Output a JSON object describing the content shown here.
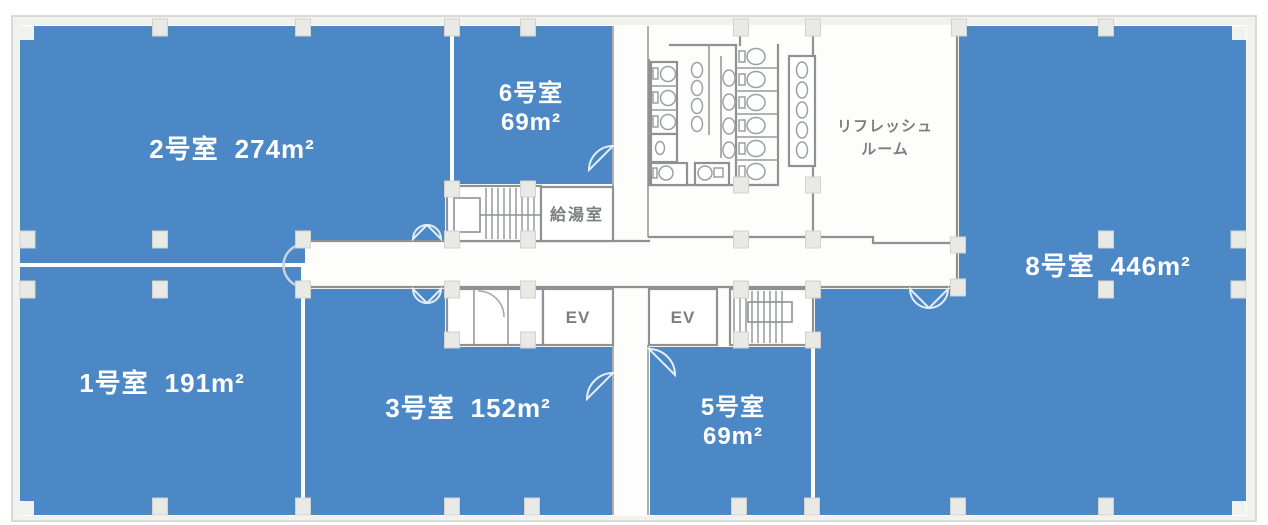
{
  "plan": {
    "type": "office-floor-plan",
    "colors": {
      "room_fill": "#4d88c6",
      "wall_line": "#8f9193",
      "wall_band": "#f1f1ee",
      "pillar": "#e9e9e5",
      "room_label": "#ffffff",
      "facility_label": "#7c7e80"
    },
    "rooms": [
      {
        "id": "1",
        "name": "1号室",
        "area": "191m²"
      },
      {
        "id": "2",
        "name": "2号室",
        "area": "274m²"
      },
      {
        "id": "3",
        "name": "3号室",
        "area": "152m²"
      },
      {
        "id": "5",
        "name": "5号室",
        "area": "69m²"
      },
      {
        "id": "6",
        "name": "6号室",
        "area": "69m²"
      },
      {
        "id": "8",
        "name": "8号室",
        "area": "446m²"
      }
    ],
    "facilities": {
      "kitchenette": "給湯室",
      "refresh_room_line1": "リフレッシュ",
      "refresh_room_line2": "ルーム",
      "elevator_left": "EV",
      "elevator_right": "EV"
    }
  }
}
